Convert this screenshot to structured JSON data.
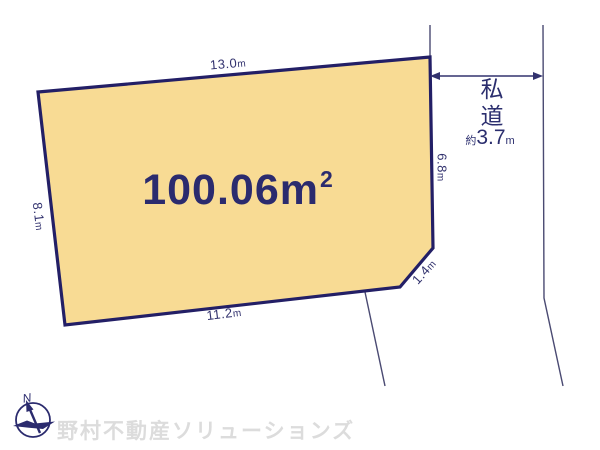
{
  "colors": {
    "plot_fill": "#F8DB94",
    "plot_border": "#231F66",
    "dimension_text": "#32326E",
    "road_line": "#4A4A72",
    "arrow": "#32326E",
    "watermark": "#DCDCDC"
  },
  "plot": {
    "area_value": "100.06",
    "area_unit": "m",
    "area_exponent": "2"
  },
  "dimensions": {
    "top": {
      "value": "13.0",
      "unit": "m"
    },
    "left": {
      "value": "8.1",
      "unit": "m"
    },
    "bottom": {
      "value": "11.2",
      "unit": "m"
    },
    "right": {
      "value": "6.8",
      "unit": "m"
    },
    "corner": {
      "value": "1.4",
      "unit": "m"
    }
  },
  "road": {
    "name": "私道",
    "width_prefix": "約",
    "width_value": "3.7",
    "width_unit": "m"
  },
  "compass": {
    "north_label": "N"
  },
  "watermark": {
    "text": "野村不動産ソリューションズ"
  }
}
